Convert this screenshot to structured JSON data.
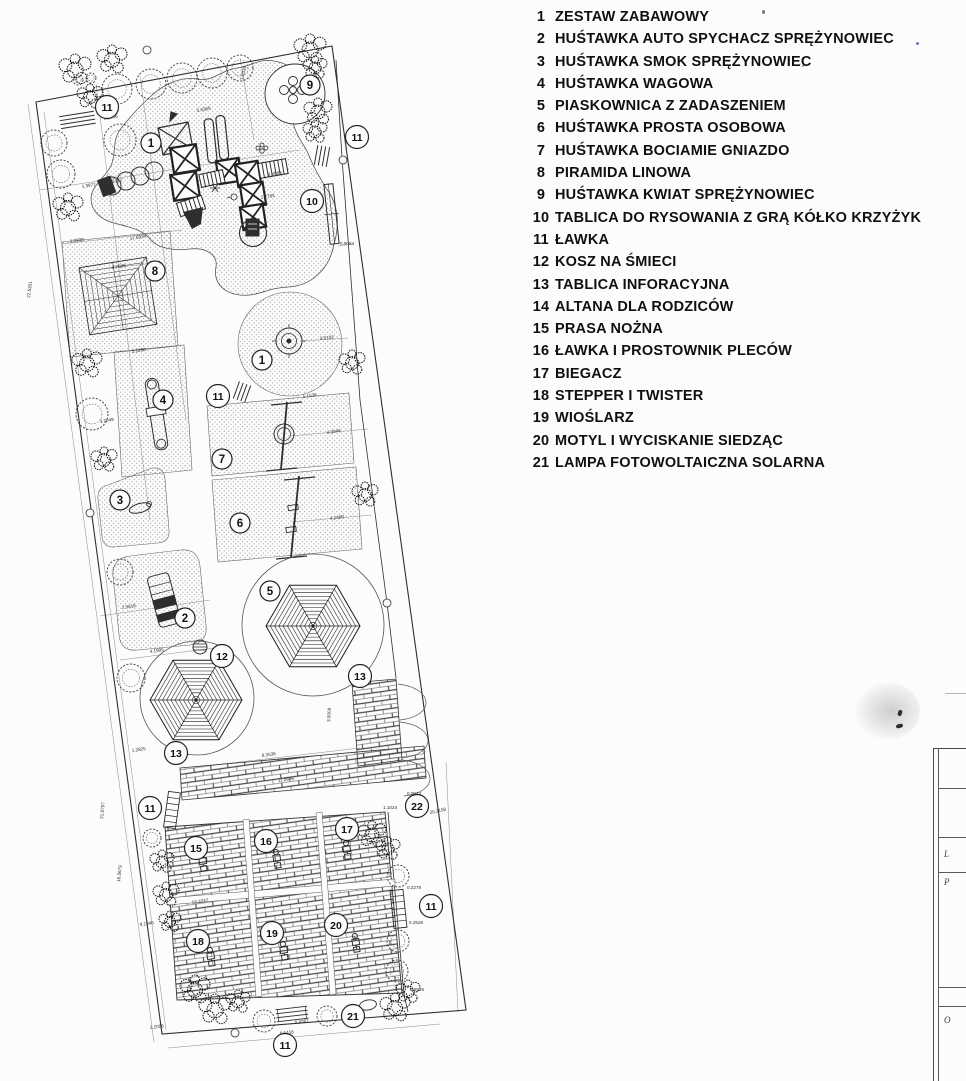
{
  "legend": {
    "items": [
      {
        "num": "1",
        "label": "ZESTAW ZABAWOWY"
      },
      {
        "num": "2",
        "label": "HUŚTAWKA AUTO SPYCHACZ SPRĘŻYNOWIEC"
      },
      {
        "num": "3",
        "label": "HUŚTAWKA SMOK SPRĘŻYNOWIEC"
      },
      {
        "num": "4",
        "label": "HUŚTAWKA WAGOWA"
      },
      {
        "num": "5",
        "label": "PIASKOWNICA Z ZADASZENIEM"
      },
      {
        "num": "6",
        "label": "HUŚTAWKA PROSTA OSOBOWA"
      },
      {
        "num": "7",
        "label": "HUŚTAWKA BOCIAMIE GNIAZDO"
      },
      {
        "num": "8",
        "label": "PIRAMIDA LINOWA"
      },
      {
        "num": "9",
        "label": "HUŚTAWKA KWIAT SPRĘŻYNOWIEC"
      },
      {
        "num": "10",
        "label": "TABLICA DO RYSOWANIA Z GRĄ KÓŁKO KRZYŻYK"
      },
      {
        "num": "11",
        "label": "ŁAWKA"
      },
      {
        "num": "12",
        "label": "KOSZ NA ŚMIECI"
      },
      {
        "num": "13",
        "label": "TABLICA INFORACYJNA"
      },
      {
        "num": "14",
        "label": "ALTANA DLA RODZICÓW"
      },
      {
        "num": "15",
        "label": "PRASA NOŻNA"
      },
      {
        "num": "16",
        "label": "ŁAWKA I PROSTOWNIK PLECÓW"
      },
      {
        "num": "17",
        "label": "BIEGACZ"
      },
      {
        "num": "18",
        "label": "STEPPER I TWISTER"
      },
      {
        "num": "19",
        "label": "WIOŚLARZ"
      },
      {
        "num": "20",
        "label": "MOTYL I WYCISKANIE SIEDZĄC"
      },
      {
        "num": "21",
        "label": "LAMPA FOTOWOLTAICZNA SOLARNA"
      }
    ]
  },
  "plan": {
    "markers": [
      {
        "n": "11",
        "x": 107,
        "y": 107
      },
      {
        "n": "9",
        "x": 310,
        "y": 85
      },
      {
        "n": "11",
        "x": 357,
        "y": 137
      },
      {
        "n": "1",
        "x": 151,
        "y": 143
      },
      {
        "n": "10",
        "x": 312,
        "y": 201
      },
      {
        "n": "8",
        "x": 155,
        "y": 271
      },
      {
        "n": "1",
        "x": 262,
        "y": 360
      },
      {
        "n": "11",
        "x": 218,
        "y": 396
      },
      {
        "n": "4",
        "x": 163,
        "y": 400
      },
      {
        "n": "7",
        "x": 222,
        "y": 459
      },
      {
        "n": "3",
        "x": 120,
        "y": 500
      },
      {
        "n": "6",
        "x": 240,
        "y": 523
      },
      {
        "n": "5",
        "x": 270,
        "y": 591
      },
      {
        "n": "2",
        "x": 185,
        "y": 618
      },
      {
        "n": "12",
        "x": 222,
        "y": 656
      },
      {
        "n": "13",
        "x": 360,
        "y": 676
      },
      {
        "n": "13",
        "x": 176,
        "y": 753
      },
      {
        "n": "22",
        "x": 417,
        "y": 806
      },
      {
        "n": "11",
        "x": 150,
        "y": 808
      },
      {
        "n": "15",
        "x": 196,
        "y": 848
      },
      {
        "n": "16",
        "x": 266,
        "y": 841
      },
      {
        "n": "17",
        "x": 347,
        "y": 829
      },
      {
        "n": "11",
        "x": 431,
        "y": 906
      },
      {
        "n": "18",
        "x": 198,
        "y": 941
      },
      {
        "n": "19",
        "x": 272,
        "y": 933
      },
      {
        "n": "20",
        "x": 336,
        "y": 925
      },
      {
        "n": "21",
        "x": 353,
        "y": 1016
      },
      {
        "n": "11",
        "x": 285,
        "y": 1045
      }
    ],
    "dimensions": [
      {
        "t": "0.2906",
        "x": 104,
        "y": 120,
        "r": -10
      },
      {
        "t": "1.9338",
        "x": 243,
        "y": 80,
        "r": -76
      },
      {
        "t": "5.0369",
        "x": 197,
        "y": 112,
        "r": -10
      },
      {
        "t": "1.3977",
        "x": 82,
        "y": 188,
        "r": -9
      },
      {
        "t": "15.6172",
        "x": 106,
        "y": 184,
        "r": -9
      },
      {
        "t": "8.5969",
        "x": 268,
        "y": 176,
        "r": -9
      },
      {
        "t": "2.7784",
        "x": 261,
        "y": 199,
        "r": -9
      },
      {
        "t": "0.9084",
        "x": 340,
        "y": 245,
        "r": 0
      },
      {
        "t": "3.0999",
        "x": 70,
        "y": 243,
        "r": -9
      },
      {
        "t": "17.6934",
        "x": 130,
        "y": 240,
        "r": -9
      },
      {
        "t": "6.7089",
        "x": 112,
        "y": 269,
        "r": -9
      },
      {
        "t": "22.5351",
        "x": 30,
        "y": 298,
        "r": -83
      },
      {
        "t": "3.1290",
        "x": 132,
        "y": 353,
        "r": -9
      },
      {
        "t": "3.6102",
        "x": 320,
        "y": 340,
        "r": -6
      },
      {
        "t": "5.1536",
        "x": 303,
        "y": 398,
        "r": -8
      },
      {
        "t": "4.3046",
        "x": 327,
        "y": 434,
        "r": -8
      },
      {
        "t": "3.2049",
        "x": 100,
        "y": 423,
        "r": -9
      },
      {
        "t": "4.2460",
        "x": 330,
        "y": 520,
        "r": -8
      },
      {
        "t": "2.5818",
        "x": 122,
        "y": 609,
        "r": -8
      },
      {
        "t": "4.1905",
        "x": 150,
        "y": 653,
        "r": -8
      },
      {
        "t": "1.2825",
        "x": 132,
        "y": 752,
        "r": -8
      },
      {
        "t": "8.3536",
        "x": 262,
        "y": 757,
        "r": -8
      },
      {
        "t": "11.0666",
        "x": 278,
        "y": 782,
        "r": -8
      },
      {
        "t": "3.5009",
        "x": 330,
        "y": 722,
        "r": -86
      },
      {
        "t": "0.0923",
        "x": 407,
        "y": 795,
        "r": 0
      },
      {
        "t": "1.1024",
        "x": 383,
        "y": 809,
        "r": 0
      },
      {
        "t": "20.2158",
        "x": 430,
        "y": 814,
        "r": -12
      },
      {
        "t": "0.2278",
        "x": 407,
        "y": 889,
        "r": 0
      },
      {
        "t": "0.2528",
        "x": 409,
        "y": 924,
        "r": 0
      },
      {
        "t": "0.6526",
        "x": 410,
        "y": 991,
        "r": 0
      },
      {
        "t": "13.3227",
        "x": 192,
        "y": 904,
        "r": -8
      },
      {
        "t": "21.8797",
        "x": 103,
        "y": 819,
        "r": -84
      },
      {
        "t": "16.5679",
        "x": 120,
        "y": 882,
        "r": -84
      },
      {
        "t": "9.1846",
        "x": 140,
        "y": 926,
        "r": -8
      },
      {
        "t": "0.4387",
        "x": 295,
        "y": 1024,
        "r": -7
      },
      {
        "t": "0.5416",
        "x": 280,
        "y": 1035,
        "r": -7
      },
      {
        "t": "1.2056",
        "x": 150,
        "y": 1029,
        "r": -7
      }
    ],
    "trees": [
      [
        117,
        89,
        15
      ],
      [
        151,
        84,
        15
      ],
      [
        182,
        78,
        15
      ],
      [
        212,
        73,
        15
      ],
      [
        240,
        68,
        13
      ],
      [
        120,
        140,
        16
      ],
      [
        54,
        143,
        13
      ],
      [
        61,
        174,
        14
      ],
      [
        92,
        414,
        16
      ],
      [
        120,
        572,
        13
      ],
      [
        131,
        678,
        14
      ],
      [
        152,
        838,
        9
      ],
      [
        264,
        1021,
        11
      ],
      [
        327,
        1016,
        10
      ],
      [
        398,
        876,
        11
      ],
      [
        398,
        941,
        11
      ],
      [
        397,
        971,
        11
      ],
      [
        78,
        80,
        5
      ],
      [
        91,
        78,
        5
      ]
    ],
    "bushes": [
      [
        75,
        70,
        1.6
      ],
      [
        112,
        60,
        1.5
      ],
      [
        90,
        97,
        1.3
      ],
      [
        68,
        208,
        1.5
      ],
      [
        310,
        50,
        1.6
      ],
      [
        315,
        68,
        1.2
      ],
      [
        318,
        112,
        1.4
      ],
      [
        315,
        132,
        1.2
      ],
      [
        87,
        364,
        1.5
      ],
      [
        104,
        460,
        1.3
      ],
      [
        352,
        363,
        1.3
      ],
      [
        365,
        495,
        1.3
      ],
      [
        162,
        862,
        1.2
      ],
      [
        166,
        895,
        1.3
      ],
      [
        170,
        922,
        1.1
      ],
      [
        195,
        990,
        1.5
      ],
      [
        215,
        1010,
        1.6
      ],
      [
        238,
        1002,
        1.2
      ],
      [
        372,
        835,
        1.4
      ],
      [
        388,
        849,
        1.2
      ],
      [
        395,
        1008,
        1.5
      ],
      [
        408,
        992,
        1.2
      ]
    ],
    "survey_points": [
      [
        147,
        50
      ],
      [
        343,
        160
      ],
      [
        90,
        513
      ],
      [
        387,
        603
      ],
      [
        235,
        1033
      ]
    ],
    "fitness_glyphs": [
      [
        203,
        863
      ],
      [
        277,
        860
      ],
      [
        347,
        851
      ],
      [
        211,
        958
      ],
      [
        284,
        952
      ],
      [
        356,
        944
      ]
    ]
  },
  "titleblock": {
    "row_labels": [
      "L",
      "P",
      "O"
    ]
  },
  "colors": {
    "paper": "#fcfcfb",
    "ink": "#2e2e2e",
    "legend_text": "#101010"
  }
}
